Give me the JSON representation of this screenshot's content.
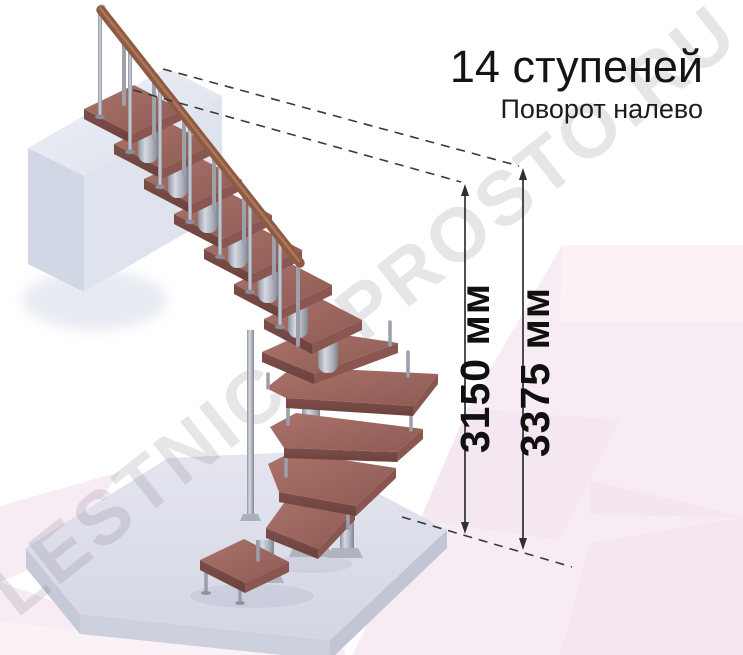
{
  "diagram": {
    "title": "14 ступеней",
    "subtitle": "Поворот налево",
    "steps_total": 14,
    "turn_direction": "налево",
    "watermark": "LESTNICA-PROSTO.RU",
    "dimensions": {
      "stair_height": {
        "label": "3150 мм",
        "value": 3150,
        "unit": "мм"
      },
      "total_height": {
        "label": "3375 мм",
        "value": 3375,
        "unit": "мм"
      }
    },
    "colors": {
      "background": "#ffffff",
      "accent_pink": "#f8ecf4",
      "accent_pink_deep": "#f2e2ec",
      "tread_wood": "#a06a62",
      "handrail_wood": "#8d5a43",
      "metal": "#b6b9c3",
      "slab_gray": "#dcdee9",
      "annotation": "#2f2f2f",
      "text": "#141414",
      "watermark_gray": "#e8e6ea"
    }
  }
}
